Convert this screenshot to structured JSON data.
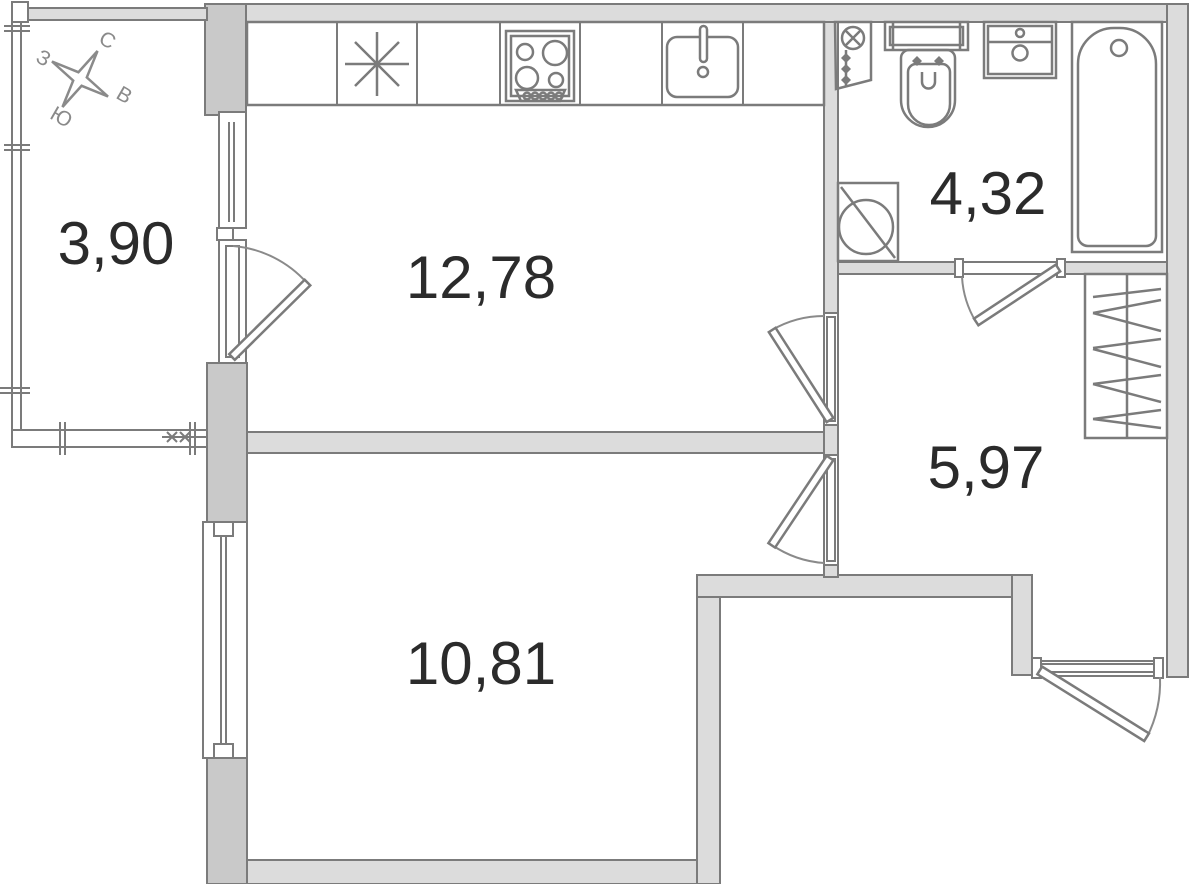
{
  "plan": {
    "type": "apartment-floor-plan",
    "rooms": {
      "balcony": {
        "area": "3,90"
      },
      "kitchen": {
        "area": "12,78"
      },
      "bathroom": {
        "area": "4,32"
      },
      "hallway": {
        "area": "5,97"
      },
      "room": {
        "area": "10,81"
      }
    },
    "compass": {
      "north": "С",
      "west": "З",
      "east": "В",
      "south": "Ю"
    },
    "fixtures": [
      "kitchen-counter",
      "asterisk-symbol",
      "stove",
      "kitchen-sink",
      "plumbing-riser",
      "toilet",
      "washbasin",
      "bathtub",
      "washing-machine",
      "wardrobe"
    ],
    "doors": [
      "balcony-door",
      "kitchen-door",
      "room-door",
      "bathroom-door",
      "entrance-door"
    ],
    "colors": {
      "wall_fill": "#dcdcdc",
      "wall_fill_dark": "#c9c9c9",
      "line": "#7b7b7b",
      "label_text": "#2b2b2b",
      "compass_text": "#8a8a8a",
      "background": "#ffffff"
    }
  }
}
